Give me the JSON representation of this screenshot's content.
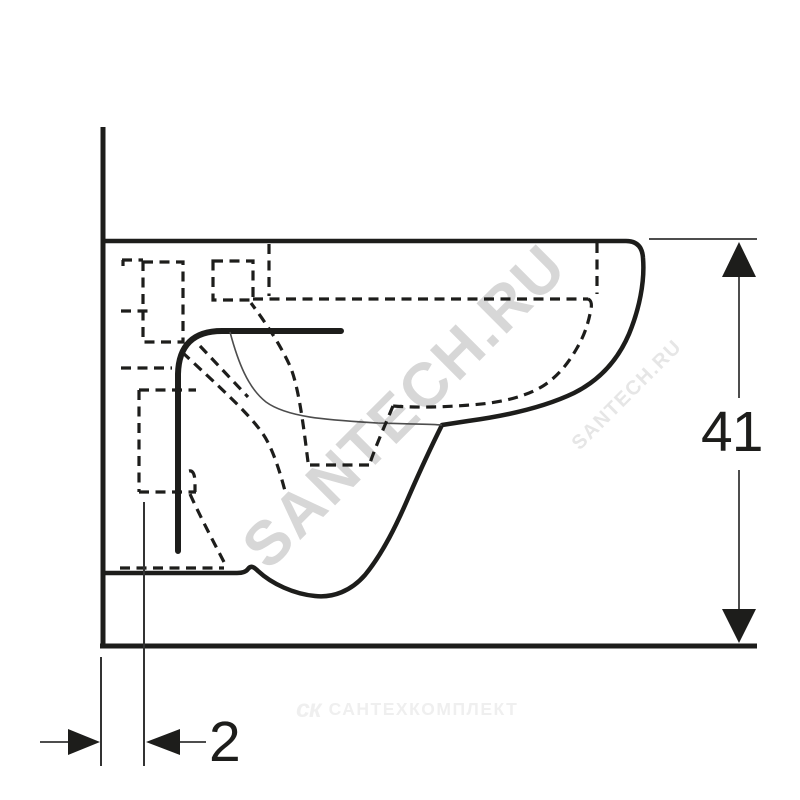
{
  "canvas": {
    "width": 800,
    "height": 800,
    "background": "#ffffff"
  },
  "dimensions": {
    "height": {
      "label": "41"
    },
    "wall_offset": {
      "label": "2"
    }
  },
  "watermarks": {
    "large_diagonal": {
      "text": "SANTECH.RU",
      "color": "#d7d7d7"
    },
    "small_diagonal": {
      "text": "SANTECH.RU",
      "color": "#e6e6e6"
    },
    "footer": {
      "logo": "ск",
      "text": "САНТЕХКОМПЛЕКТ",
      "color": "#efefef"
    }
  },
  "style": {
    "solid_line_color": "#1d1d1b",
    "thin_line_color": "#4d4d4d",
    "dimension_line_color": "#4d4d4d"
  }
}
